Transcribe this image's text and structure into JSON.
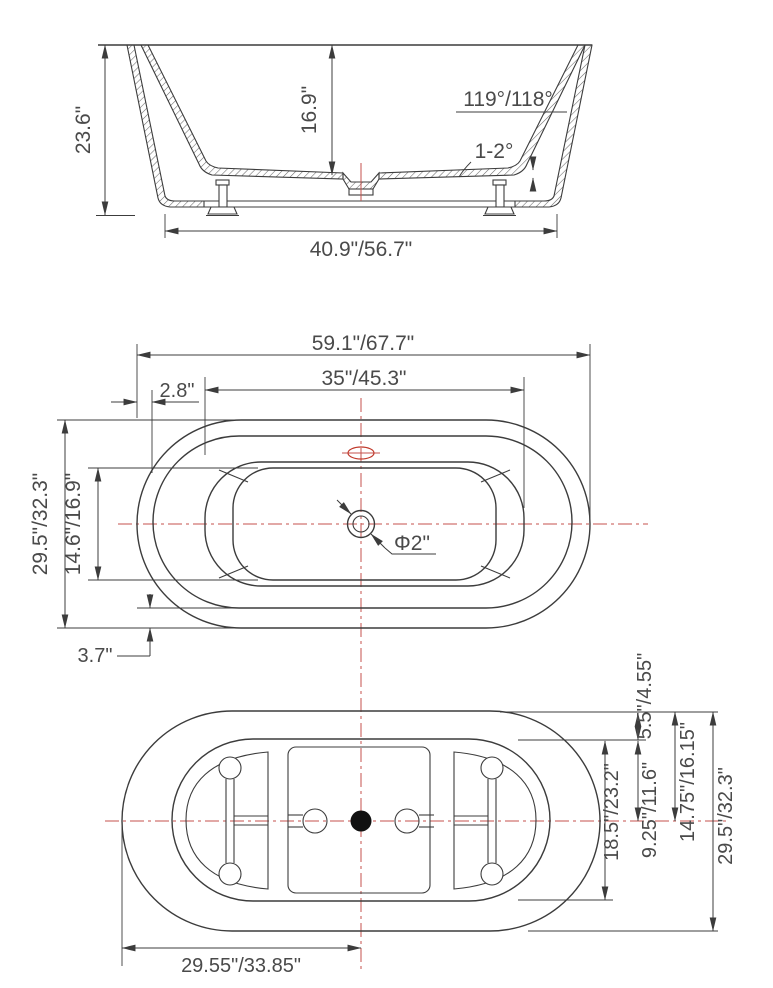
{
  "drawing_title": "bathtub-three-view-dimension-drawing",
  "colors": {
    "line": "#3c3c3c",
    "text": "#4a4a4a",
    "centerline_red": "#c4524c"
  },
  "side_view": {
    "name": "side elevation",
    "overall_height": "23.6\"",
    "inner_depth": "16.9\"",
    "wall_angle": "119°/118°",
    "floor_slope": "1-2°",
    "base_length": "40.9\"/56.7\""
  },
  "plan_view": {
    "name": "top plan",
    "overall_length": "59.1\"/67.7\"",
    "basin_length": "35\"/45.3\"",
    "rim_end_width": "2.8\"",
    "overall_width": "29.5\"/32.3\"",
    "basin_width": "14.6\"/16.9\"",
    "drain_diameter": "Φ2\"",
    "rim_side_width": "3.7\""
  },
  "bottom_view": {
    "name": "bottom view",
    "base_end_offset": "5.5\"/4.55\"",
    "base_length": "18.5\"/23.2\"",
    "base_half_length": "9.25\"/11.6\"",
    "top_to_center": "14.75\"/16.15\"",
    "overall_width": "29.5\"/32.3\"",
    "half_length": "29.55\"/33.85\""
  }
}
